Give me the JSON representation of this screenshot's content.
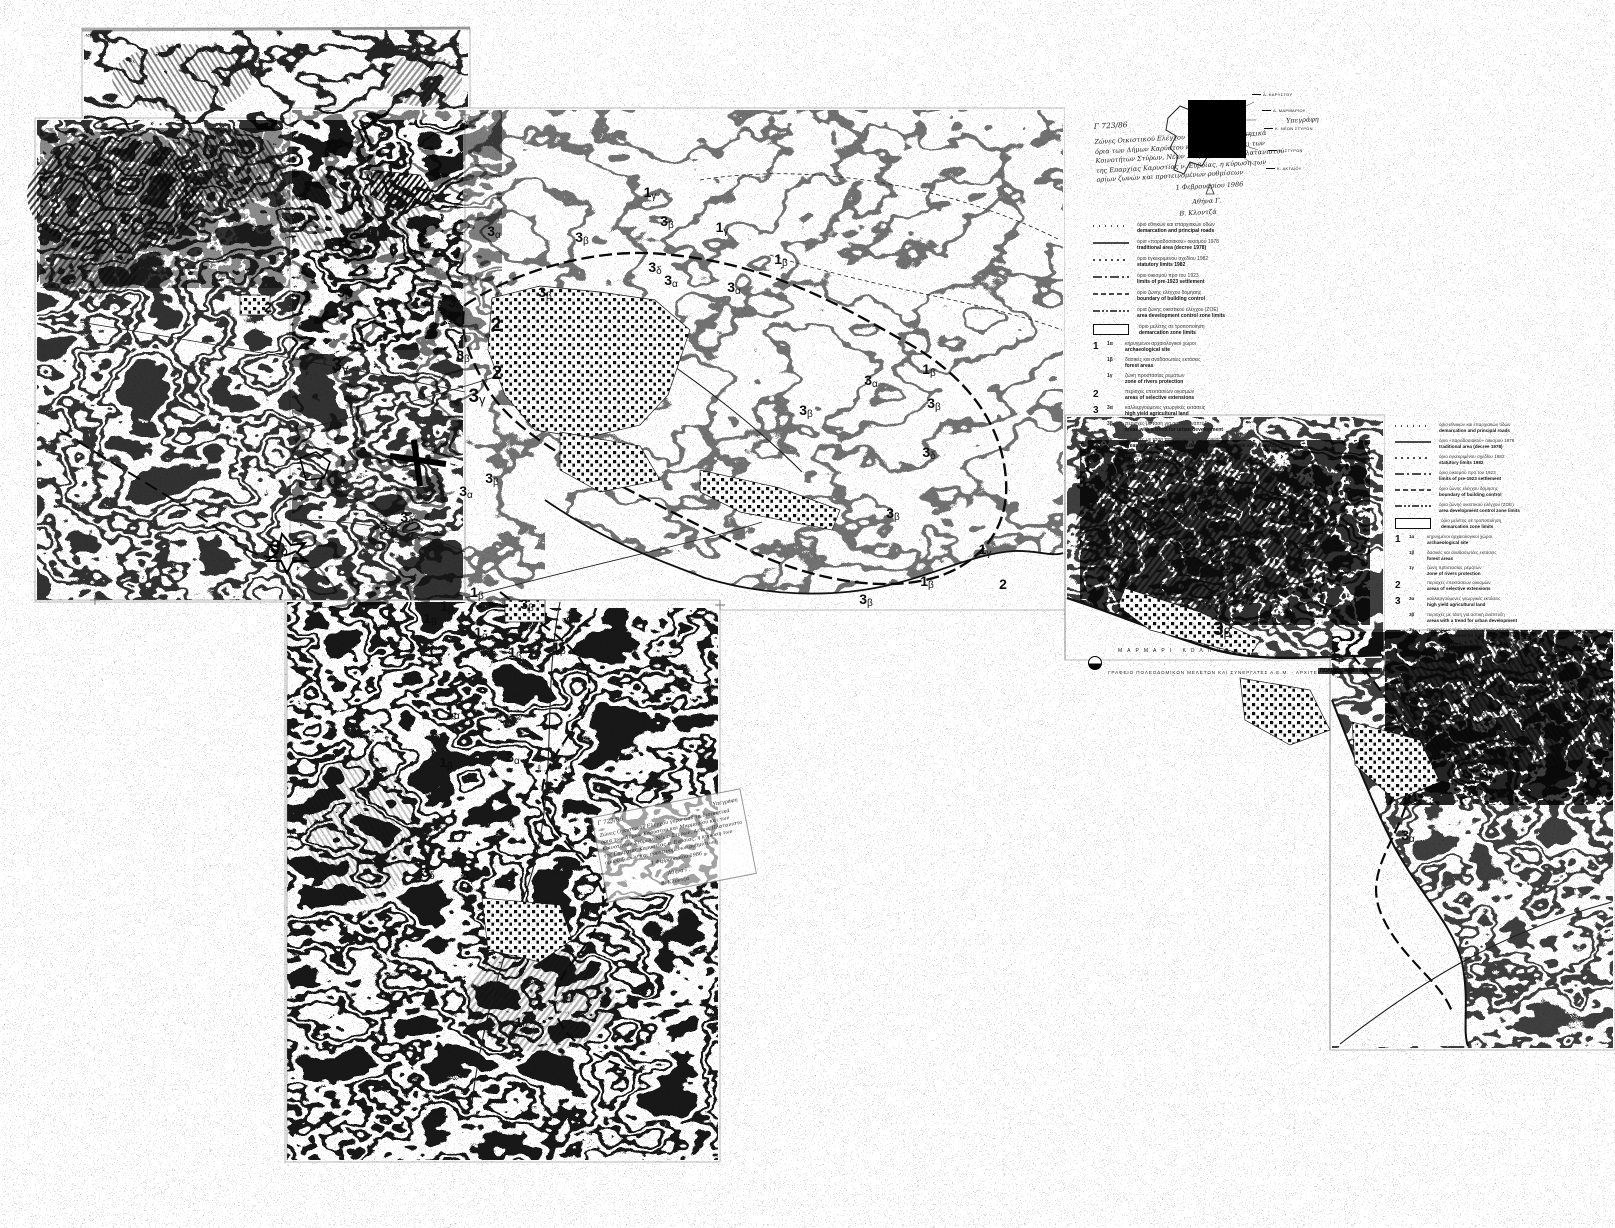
{
  "colors": {
    "paper": "#ffffff",
    "ink": "#111111",
    "scan_gray": "#b9b9b9"
  },
  "sea_label": "ΜΑΡΜΑΡΙ ΚΟΛΠΟΣ",
  "credit": {
    "firm": "ΓΡΑΦΕΙΟ ΠΟΛΕΟΔΟΜΙΚΩΝ ΜΕΛΕΤΩΝ ΚΑΙ ΣΥΝΕΡΓΑΤΕΣ Α.Ε.Μ. - ΑΡΧΙΤΕΚΤΟΝΕΣ",
    "stamp": "ΠΟΛΕΟΔΟΜΙΚΗ ΜΕΛΕΤΗ"
  },
  "note": {
    "ref": "Γ 723/86",
    "tag": "Υπεγράφη",
    "lines": [
      "Ζώνες Οικιστικού Ελέγχου γύρω από τα διοικητικά",
      "όρια των Δήμων Καρύστου και Μαρμαρίου και των",
      "Κοινοτήτων Στύρων, Νέων Στύρων, Αετού, Πλατανιστού",
      "της Επαρχίας Καρυστίας ν. Ευβοίας, η κύρωση των",
      "ορίων ζωνών και προτεινομένων ρυθμίσεων"
    ],
    "date": "1 Φεβρουαρίου 1986",
    "sig1": "Αθήνα Γ.",
    "sig2": "Β. Κλοντζά"
  },
  "inset": {
    "labels": [
      {
        "t": "Δ. ΚΑΡΥΣΤΟΥ",
        "x": 112,
        "y": 6
      },
      {
        "t": "Δ. ΜΑΡΜΑΡΙΟΥ",
        "x": 122,
        "y": 22
      },
      {
        "t": "Κ. ΝΕΩΝ ΣΤΥΡΩΝ",
        "x": 124,
        "y": 40
      },
      {
        "t": "Κ. ΣΤΥΡΩΝ",
        "x": 128,
        "y": 62
      },
      {
        "t": "Κ. ΑΚΤΑΙΟΥ",
        "x": 126,
        "y": 80
      }
    ]
  },
  "legend": {
    "lines": [
      {
        "dash": "1 5",
        "gr": "όριο εθνικών και επαρχιακών οδών",
        "en": "demarcation and principal roads"
      },
      {
        "dash": "solid",
        "gr": "όριο «παραδοσιακού» οικισμού 1978",
        "en": "traditional area (decree 1978)"
      },
      {
        "dash": "2 4",
        "gr": "όριο εγκεκριμένου σχεδίου 1982",
        "en": "statutory limits 1982"
      },
      {
        "dash": "9 3 2 3",
        "gr": "όριο οικισμού προ του 1923",
        "en": "limits of pre-1923 settlement"
      },
      {
        "dash": "5 3",
        "gr": "όριο ζώνης ελέγχου δόμησης",
        "en": "boundary of building control"
      },
      {
        "dash": "7 2 2 2 2 2",
        "gr": "όρια ζώνης οικιστικού ελέγχου (ΖΟΕ)",
        "en": "area development control zone limits"
      }
    ],
    "box": {
      "gr": "όριο μελέτης σε τροποποίηση",
      "en": "demarcation zone limits"
    },
    "numbered": [
      {
        "n": "1",
        "c": "1α",
        "gr": "κηρυγμένοι αρχαιολογικοί χώροι",
        "en": "archaeological site"
      },
      {
        "n": "",
        "c": "1β",
        "gr": "δασικές και αναδασωτέες εκτάσεις",
        "en": "forest areas"
      },
      {
        "n": "",
        "c": "1γ",
        "gr": "ζώνη προστασίας ρεμάτων",
        "en": "zone of rivers protection"
      },
      {
        "n": "2",
        "c": "",
        "gr": "περιοχές επεκτάσεων οικισμών",
        "en": "areas of selective extensions"
      },
      {
        "n": "3",
        "c": "3α",
        "gr": "καλλιεργούμενες γεωργικές εκτάσεις",
        "en": "high yield agricultural land"
      },
      {
        "n": "",
        "c": "3β",
        "gr": "περιοχές με τάση για αστική ανάπτυξη",
        "en": "areas with a trend for urban development"
      },
      {
        "n": "",
        "c": "3γ",
        "gr": "περιοχές με τάση παραθεριστικής κατοικίας",
        "en": "areas with a trend for light development and whole area development"
      },
      {
        "n": "",
        "c": "3δ",
        "gr": "υπόλοιπες γεωργικές εκτάσεις",
        "en": "agricultural land"
      }
    ]
  },
  "zone_labels": [
    {
      "n": "1",
      "s": "γ",
      "x": 650,
      "y": 193
    },
    {
      "n": "3",
      "s": "α",
      "x": 494,
      "y": 232
    },
    {
      "n": "3",
      "s": "β",
      "x": 582,
      "y": 238
    },
    {
      "n": "1",
      "s": "γ",
      "x": 722,
      "y": 228
    },
    {
      "n": "3",
      "s": "β",
      "x": 667,
      "y": 222
    },
    {
      "n": "3",
      "s": "δ",
      "x": 655,
      "y": 268
    },
    {
      "n": "1",
      "s": "β",
      "x": 781,
      "y": 260
    },
    {
      "n": "3",
      "s": "α",
      "x": 671,
      "y": 281
    },
    {
      "n": "3",
      "s": "α",
      "x": 734,
      "y": 288
    },
    {
      "n": "2",
      "s": "",
      "x": 268,
      "y": 308
    },
    {
      "n": "3",
      "s": "β",
      "x": 344,
      "y": 293
    },
    {
      "n": "3",
      "s": "α",
      "x": 455,
      "y": 303
    },
    {
      "n": "3",
      "s": "β",
      "x": 545,
      "y": 293
    },
    {
      "n": "2",
      "s": "",
      "x": 496,
      "y": 326,
      "cls": "big"
    },
    {
      "n": "3",
      "s": "β",
      "x": 463,
      "y": 356
    },
    {
      "n": "2",
      "s": "",
      "x": 497,
      "y": 374,
      "cls": "big"
    },
    {
      "n": "3",
      "s": "γ",
      "x": 477,
      "y": 397,
      "cls": "big"
    },
    {
      "n": "3",
      "s": "γ",
      "x": 340,
      "y": 366,
      "cls": "big"
    },
    {
      "n": "3",
      "s": "α",
      "x": 871,
      "y": 381
    },
    {
      "n": "1",
      "s": "β",
      "x": 929,
      "y": 370
    },
    {
      "n": "3",
      "s": "β",
      "x": 934,
      "y": 404
    },
    {
      "n": "3",
      "s": "β",
      "x": 806,
      "y": 411
    },
    {
      "n": "3",
      "s": "δ",
      "x": 929,
      "y": 453
    },
    {
      "n": "3",
      "s": "β",
      "x": 893,
      "y": 514
    },
    {
      "n": "3",
      "s": "β",
      "x": 492,
      "y": 479
    },
    {
      "n": "3",
      "s": "α",
      "x": 466,
      "y": 492
    },
    {
      "n": "3",
      "s": "δ",
      "x": 407,
      "y": 518
    },
    {
      "n": "3",
      "s": "α",
      "x": 387,
      "y": 527
    },
    {
      "n": "1",
      "s": "γ",
      "x": 985,
      "y": 550
    },
    {
      "n": "1",
      "s": "β",
      "x": 927,
      "y": 582
    },
    {
      "n": "2",
      "s": "",
      "x": 1003,
      "y": 585
    },
    {
      "n": "3",
      "s": "β",
      "x": 866,
      "y": 600
    },
    {
      "n": "3",
      "s": "δ",
      "x": 279,
      "y": 548,
      "cls": "big"
    },
    {
      "n": "3",
      "s": "δ",
      "x": 1085,
      "y": 484,
      "cls": "big"
    },
    {
      "n": "1",
      "s": "β",
      "x": 447,
      "y": 607
    },
    {
      "n": "1",
      "s": "β",
      "x": 477,
      "y": 593
    },
    {
      "n": "3",
      "s": "β",
      "x": 527,
      "y": 605
    },
    {
      "n": "1",
      "s": "α",
      "x": 481,
      "y": 633
    },
    {
      "n": "1",
      "s": "β",
      "x": 430,
      "y": 619
    },
    {
      "n": "1",
      "s": "β",
      "x": 515,
      "y": 653
    },
    {
      "n": "1",
      "s": "β",
      "x": 559,
      "y": 648
    },
    {
      "n": "1",
      "s": "α",
      "x": 434,
      "y": 653
    },
    {
      "n": "1",
      "s": "α",
      "x": 453,
      "y": 713
    },
    {
      "n": "3",
      "s": "α",
      "x": 513,
      "y": 758
    },
    {
      "n": "1",
      "s": "β",
      "x": 446,
      "y": 763
    },
    {
      "n": "3",
      "s": "δ",
      "x": 428,
      "y": 873
    },
    {
      "n": "3",
      "s": "γ",
      "x": 468,
      "y": 876
    },
    {
      "n": "1",
      "s": "γ",
      "x": 521,
      "y": 1023
    },
    {
      "n": "3",
      "s": "β",
      "x": 1222,
      "y": 630,
      "cls": "big"
    },
    {
      "n": "3",
      "s": "δ",
      "x": 1270,
      "y": 616
    },
    {
      "n": "1",
      "s": "β",
      "x": 1337,
      "y": 656
    },
    {
      "n": "3",
      "s": "β",
      "x": 1420,
      "y": 733
    },
    {
      "n": "3",
      "s": "γ",
      "x": 1487,
      "y": 773
    },
    {
      "n": "3",
      "s": "α",
      "x": 1408,
      "y": 836
    }
  ]
}
